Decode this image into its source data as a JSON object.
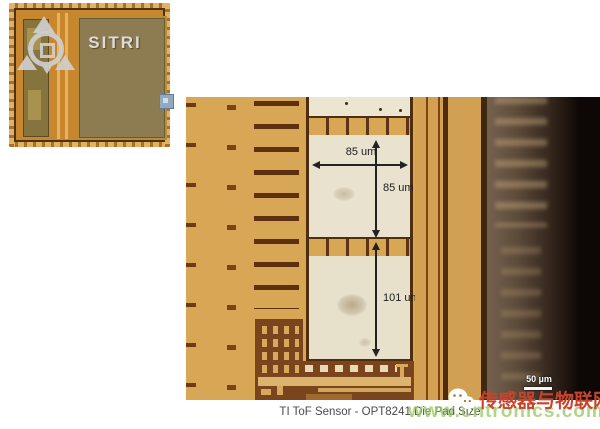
{
  "die_photo": {
    "logo_text": "SITRI"
  },
  "micrograph": {
    "pad_width_label": "85 um",
    "pad_height_label": "85 um",
    "bottom_pad_height_label": "101 um",
    "scale_bar_label": "50 µm"
  },
  "caption": "TI ToF Sensor - OPT8241 Die Pad Size",
  "watermark": {
    "brand_text": "传感器与物联网",
    "url_text": "www.cntronics.com",
    "brand_color": "#c8432e",
    "url_color": "#9bc85a"
  },
  "colors": {
    "micrograph_background": "#d7a756",
    "pad_fill": "#e9e2cf",
    "pad_border": "#4f2e10",
    "metal_brown": "#7a441c",
    "annotation": "#222222",
    "die_gold": "#c8872e",
    "sensor_array_olive": "#8d7c52"
  }
}
